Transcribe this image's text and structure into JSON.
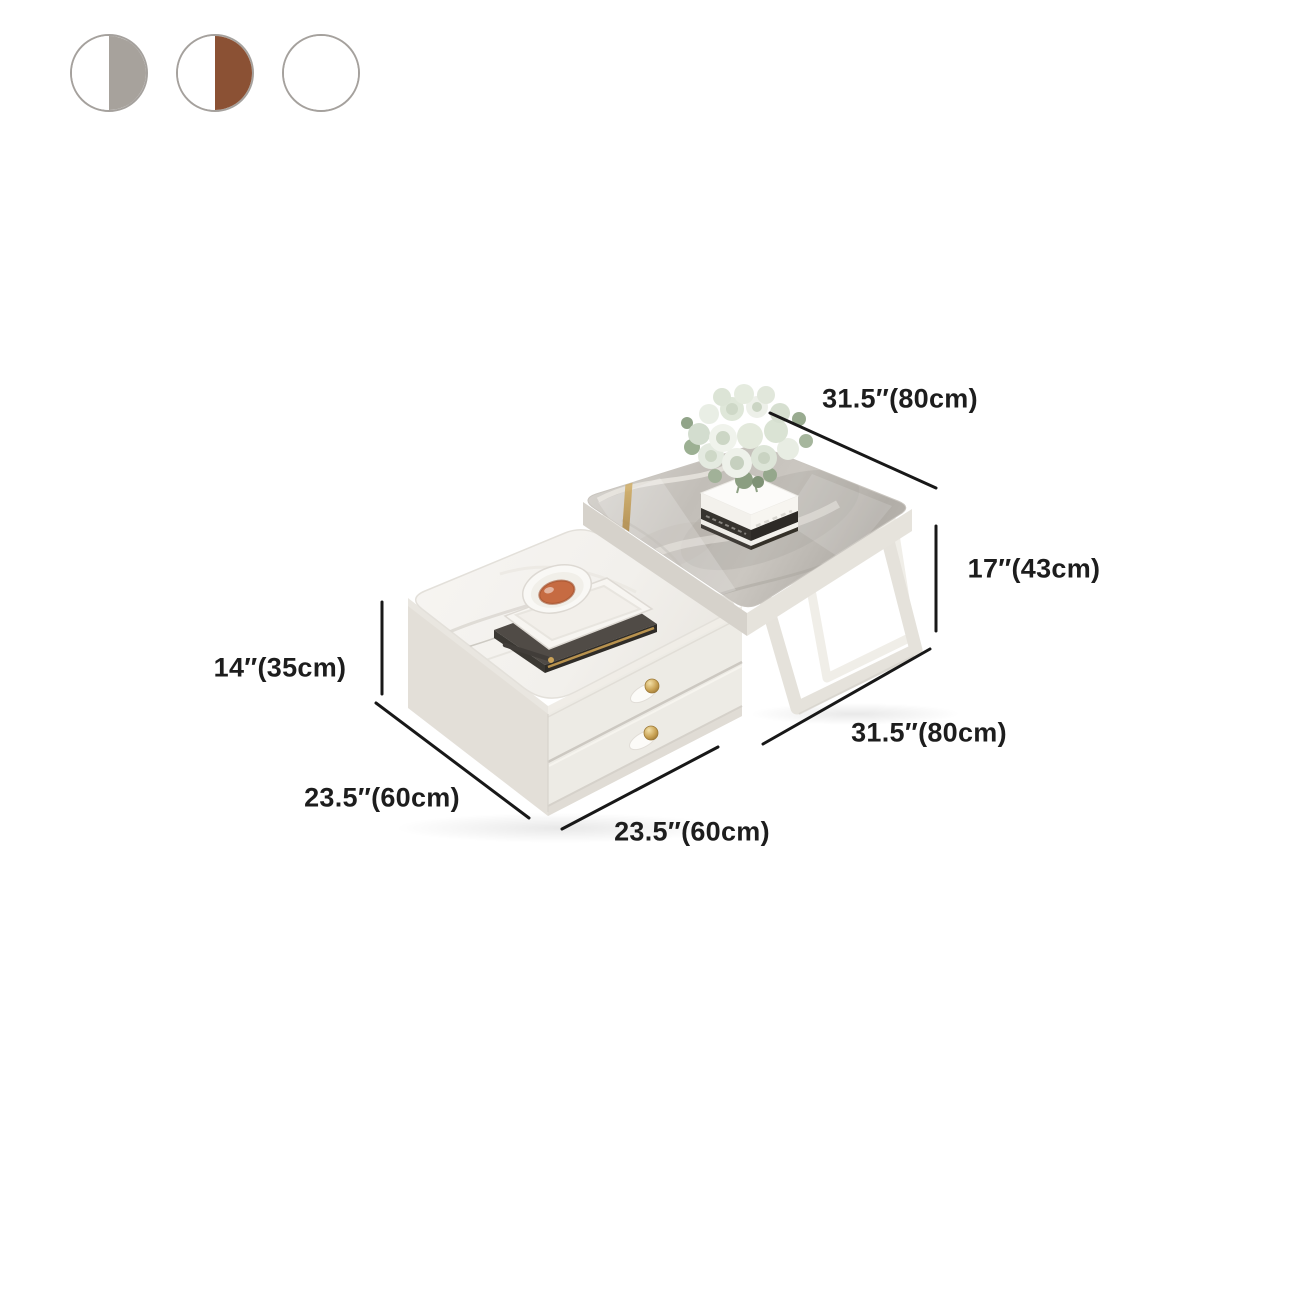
{
  "canvas": {
    "background": "#ffffff"
  },
  "color_options": {
    "border_color": "#a5a19d",
    "swatches": [
      {
        "id": "white-grey",
        "left_color": "#ffffff",
        "right_color": "#a7a29c"
      },
      {
        "id": "white-brown",
        "left_color": "#ffffff",
        "right_color": "#8b5134"
      },
      {
        "id": "white",
        "left_color": "#ffffff",
        "right_color": "#ffffff"
      }
    ]
  },
  "dimensions": {
    "large_table": {
      "width": "31.5″(80cm)",
      "height": "17″(43cm)",
      "depth": "31.5″(80cm)"
    },
    "small_table": {
      "height": "14″(35cm)",
      "depth": "23.5″(60cm)",
      "width": "23.5″(60cm)"
    }
  },
  "annotation": {
    "line_color": "#181818",
    "text_color": "#1d1d1d"
  },
  "palette": {
    "marble_grey": "#c0bcb6",
    "frame_white": "#e5e2db",
    "cabinet_white": "#edebe5",
    "gold_accent": "#c9a254"
  }
}
